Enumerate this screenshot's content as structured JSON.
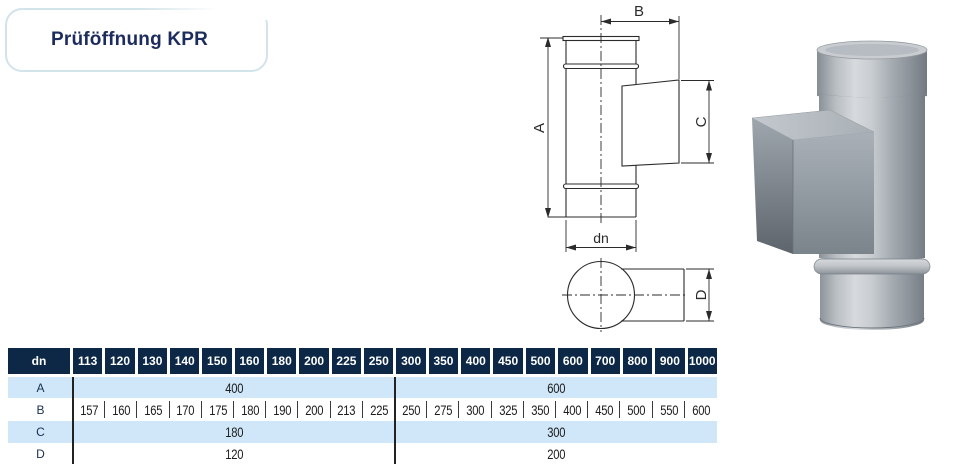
{
  "page": {
    "title": "Prüföffnung KPR"
  },
  "drawing": {
    "labels": {
      "height": "A",
      "width": "B",
      "opening_height": "C",
      "diameter": "dn",
      "depth": "D"
    }
  },
  "table": {
    "header": {
      "dn_label": "dn",
      "columns": [
        "113",
        "120",
        "130",
        "140",
        "150",
        "160",
        "180",
        "200",
        "225",
        "250",
        "300",
        "350",
        "400",
        "450",
        "500",
        "600",
        "700",
        "800",
        "900",
        "1000"
      ]
    },
    "rows": {
      "a": {
        "label": "A",
        "group1": "400",
        "group2": "600"
      },
      "b": {
        "label": "B",
        "values": [
          "157",
          "160",
          "165",
          "170",
          "175",
          "180",
          "190",
          "200",
          "213",
          "225",
          "250",
          "275",
          "300",
          "325",
          "350",
          "400",
          "450",
          "500",
          "550",
          "600"
        ]
      },
      "c": {
        "label": "C",
        "group1": "180",
        "group2": "300"
      },
      "d": {
        "label": "D",
        "group1": "120",
        "group2": "200"
      }
    }
  },
  "colors": {
    "header_navy": "#0d2847",
    "row_blue": "#cfe7f8",
    "title_navy": "#1d2c5e",
    "title_border": "#d2e4ea",
    "table_line": "#222222",
    "drawing_line": "#2b2b2b"
  }
}
